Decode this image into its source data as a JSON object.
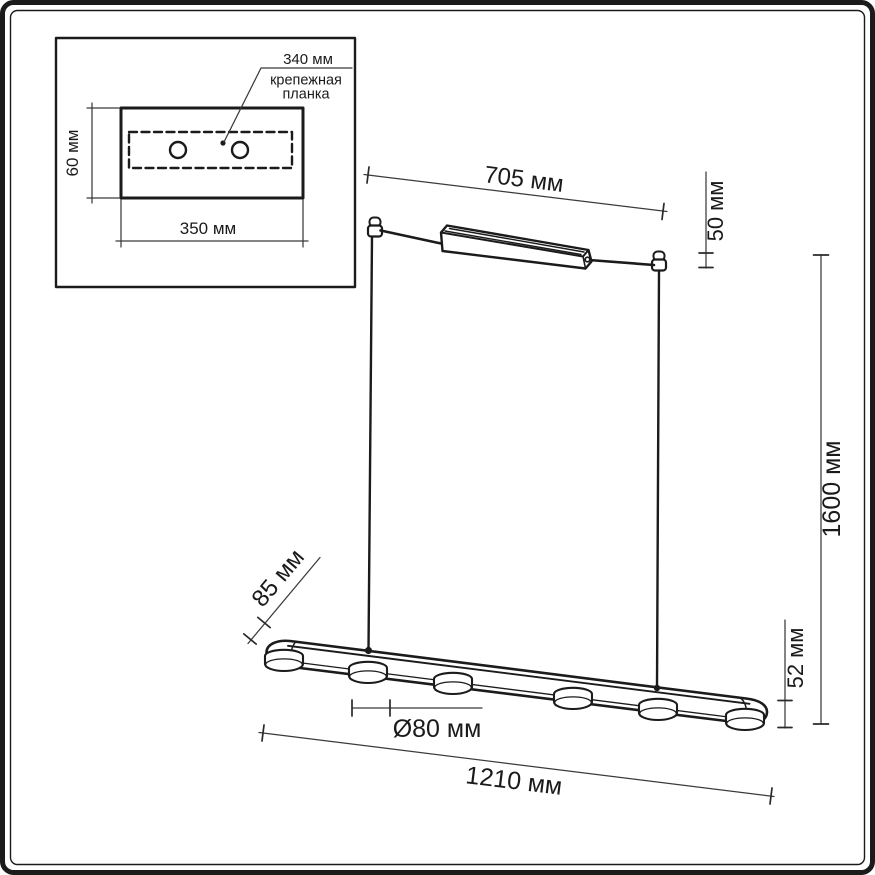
{
  "colors": {
    "background": "#ffffff",
    "line": "#1b1b1b",
    "dimension_line": "#3a3a3a",
    "text": "#1a1a1a"
  },
  "inset": {
    "dim_plate_length": "340 мм",
    "mounting_plate_label_line1": "крепежная",
    "mounting_plate_label_line2": "планка",
    "dim_canopy_depth": "60 мм",
    "dim_canopy_width": "350 мм",
    "screw_hole_count": 2
  },
  "fixture": {
    "dim_canopy_length": "705 мм",
    "dim_canopy_height": "50 мм",
    "dim_suspension_length": "1600 мм",
    "dim_bar_depth": "85 мм",
    "dim_bar_height": "52 мм",
    "dim_spot_diameter": "Ø80 мм",
    "dim_bar_length": "1210 мм",
    "spot_count": 6
  }
}
